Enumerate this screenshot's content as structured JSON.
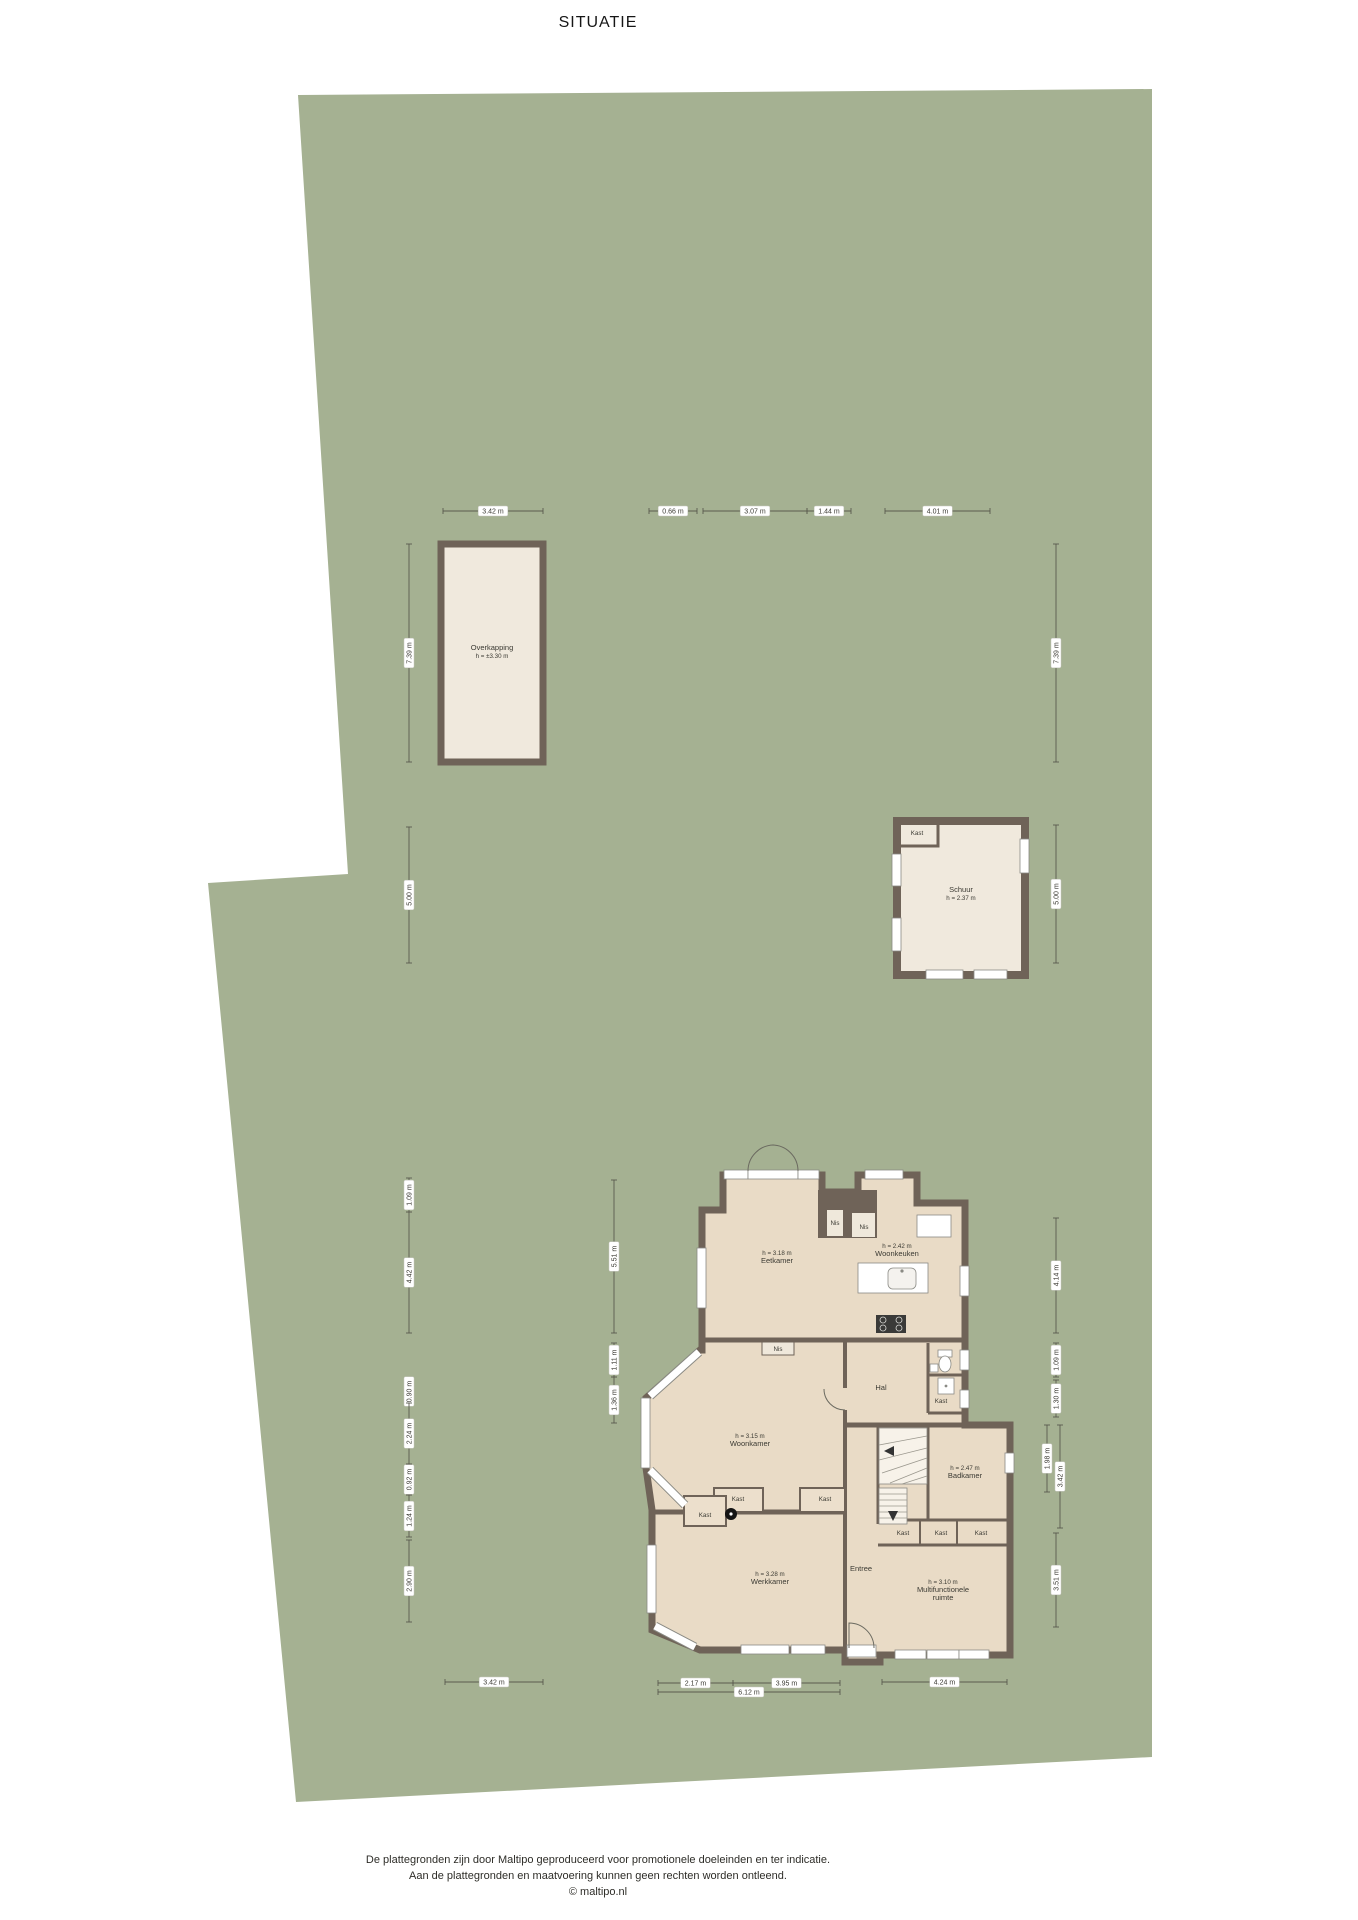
{
  "title": "SITUATIE",
  "footer": {
    "line1": "De plattegronden zijn door Maltipo geproduceerd voor promotionele doeleinden en ter indicatie.",
    "line2": "Aan de plattegronden en maatvoering kunnen geen rechten worden ontleend.",
    "line3": "© maltipo.nl"
  },
  "colors": {
    "plot_green": "#a5b192",
    "wall": "#6f6358",
    "floor_house": "#e9dbc6",
    "floor_outbuilding": "#f0e9dd",
    "window_white": "#ffffff",
    "dim_line": "#5a5b4e"
  },
  "rooms": [
    {
      "sub": "h = 3.18 m",
      "name": "Eetkamer",
      "x": 777,
      "y": 1255
    },
    {
      "sub": "h = 2.42 m",
      "name": "Woonkeuken",
      "x": 897,
      "y": 1248
    },
    {
      "sub": "h = 3.15 m",
      "name": "Woonkamer",
      "x": 750,
      "y": 1438
    },
    {
      "name": "Hal",
      "x": 881,
      "y": 1390
    },
    {
      "sub": "h = 2.47 m",
      "name": "Badkamer",
      "x": 965,
      "y": 1470
    },
    {
      "sub": "h = 3.28 m",
      "name": "Werkkamer",
      "x": 770,
      "y": 1576
    },
    {
      "name": "Entree",
      "x": 861,
      "y": 1571
    },
    {
      "sub": "h = 3.10 m",
      "name": "Multifunctionele",
      "name2": "ruimte",
      "x": 943,
      "y": 1584
    },
    {
      "name": "Overkapping",
      "sub2": "h = ±3.30 m",
      "x": 492,
      "y": 650
    },
    {
      "name": "Schuur",
      "sub2": "h = 2.37 m",
      "x": 961,
      "y": 892
    }
  ],
  "small_labels": [
    {
      "text": "Kast",
      "x": 917,
      "y": 835
    },
    {
      "text": "Kast",
      "x": 941,
      "y": 1403
    },
    {
      "text": "Kast",
      "x": 738,
      "y": 1501
    },
    {
      "text": "Kast",
      "x": 825,
      "y": 1501
    },
    {
      "text": "Kast",
      "x": 705,
      "y": 1517
    },
    {
      "text": "Kast",
      "x": 903,
      "y": 1535
    },
    {
      "text": "Kast",
      "x": 941,
      "y": 1535
    },
    {
      "text": "Kast",
      "x": 981,
      "y": 1535
    },
    {
      "text": "Nis",
      "x": 835,
      "y": 1225
    },
    {
      "text": "Nis",
      "x": 864,
      "y": 1229
    },
    {
      "text": "Nis",
      "x": 778,
      "y": 1351
    }
  ],
  "dimensions": [
    {
      "value": "3.42 m",
      "x1": 443,
      "x2": 543,
      "y": 511
    },
    {
      "value": "0.66 m",
      "x1": 649,
      "x2": 697,
      "y": 511
    },
    {
      "value": "3.07 m",
      "x1": 703,
      "x2": 807,
      "y": 511
    },
    {
      "value": "1.44 m",
      "x1": 807,
      "x2": 851,
      "y": 511
    },
    {
      "value": "4.01 m",
      "x1": 885,
      "x2": 990,
      "y": 511
    },
    {
      "value": "3.42 m",
      "x1": 445,
      "x2": 543,
      "y": 1682
    },
    {
      "value": "2.17 m",
      "x1": 658,
      "x2": 733,
      "y": 1683
    },
    {
      "value": "3.95 m",
      "x1": 733,
      "x2": 840,
      "y": 1683
    },
    {
      "value": "4.24 m",
      "x1": 882,
      "x2": 1007,
      "y": 1682
    },
    {
      "value": "6.12 m",
      "x1": 658,
      "x2": 840,
      "y": 1692
    },
    {
      "value": "7.39 m",
      "x": 409,
      "y1": 544,
      "y2": 762
    },
    {
      "value": "5.00 m",
      "x": 409,
      "y1": 827,
      "y2": 963
    },
    {
      "value": "1.09 m",
      "x": 409,
      "y1": 1178,
      "y2": 1212
    },
    {
      "value": "4.42 m",
      "x": 409,
      "y1": 1212,
      "y2": 1333
    },
    {
      "value": "0.90 m",
      "x": 409,
      "y1": 1380,
      "y2": 1403
    },
    {
      "value": "2.24 m",
      "x": 409,
      "y1": 1403,
      "y2": 1464
    },
    {
      "value": "0.92 m",
      "x": 409,
      "y1": 1464,
      "y2": 1495
    },
    {
      "value": "1.24 m",
      "x": 409,
      "y1": 1495,
      "y2": 1537
    },
    {
      "value": "2.90 m",
      "x": 409,
      "y1": 1540,
      "y2": 1622
    },
    {
      "value": "5.51 m",
      "x": 614,
      "y1": 1180,
      "y2": 1333
    },
    {
      "value": "1.11 m",
      "x": 614,
      "y1": 1343,
      "y2": 1377
    },
    {
      "value": "1.36 m",
      "x": 614,
      "y1": 1377,
      "y2": 1423
    },
    {
      "value": "7.39 m",
      "x": 1056,
      "y1": 544,
      "y2": 762
    },
    {
      "value": "5.00 m",
      "x": 1056,
      "y1": 825,
      "y2": 963
    },
    {
      "value": "4.14 m",
      "x": 1056,
      "y1": 1218,
      "y2": 1333
    },
    {
      "value": "1.09 m",
      "x": 1056,
      "y1": 1343,
      "y2": 1377
    },
    {
      "value": "1.30 m",
      "x": 1056,
      "y1": 1380,
      "y2": 1417
    },
    {
      "value": "1.98 m",
      "x": 1047,
      "y1": 1425,
      "y2": 1492
    },
    {
      "value": "3.42 m",
      "x": 1060,
      "y1": 1425,
      "y2": 1528
    },
    {
      "value": "3.51 m",
      "x": 1056,
      "y1": 1533,
      "y2": 1627
    }
  ]
}
